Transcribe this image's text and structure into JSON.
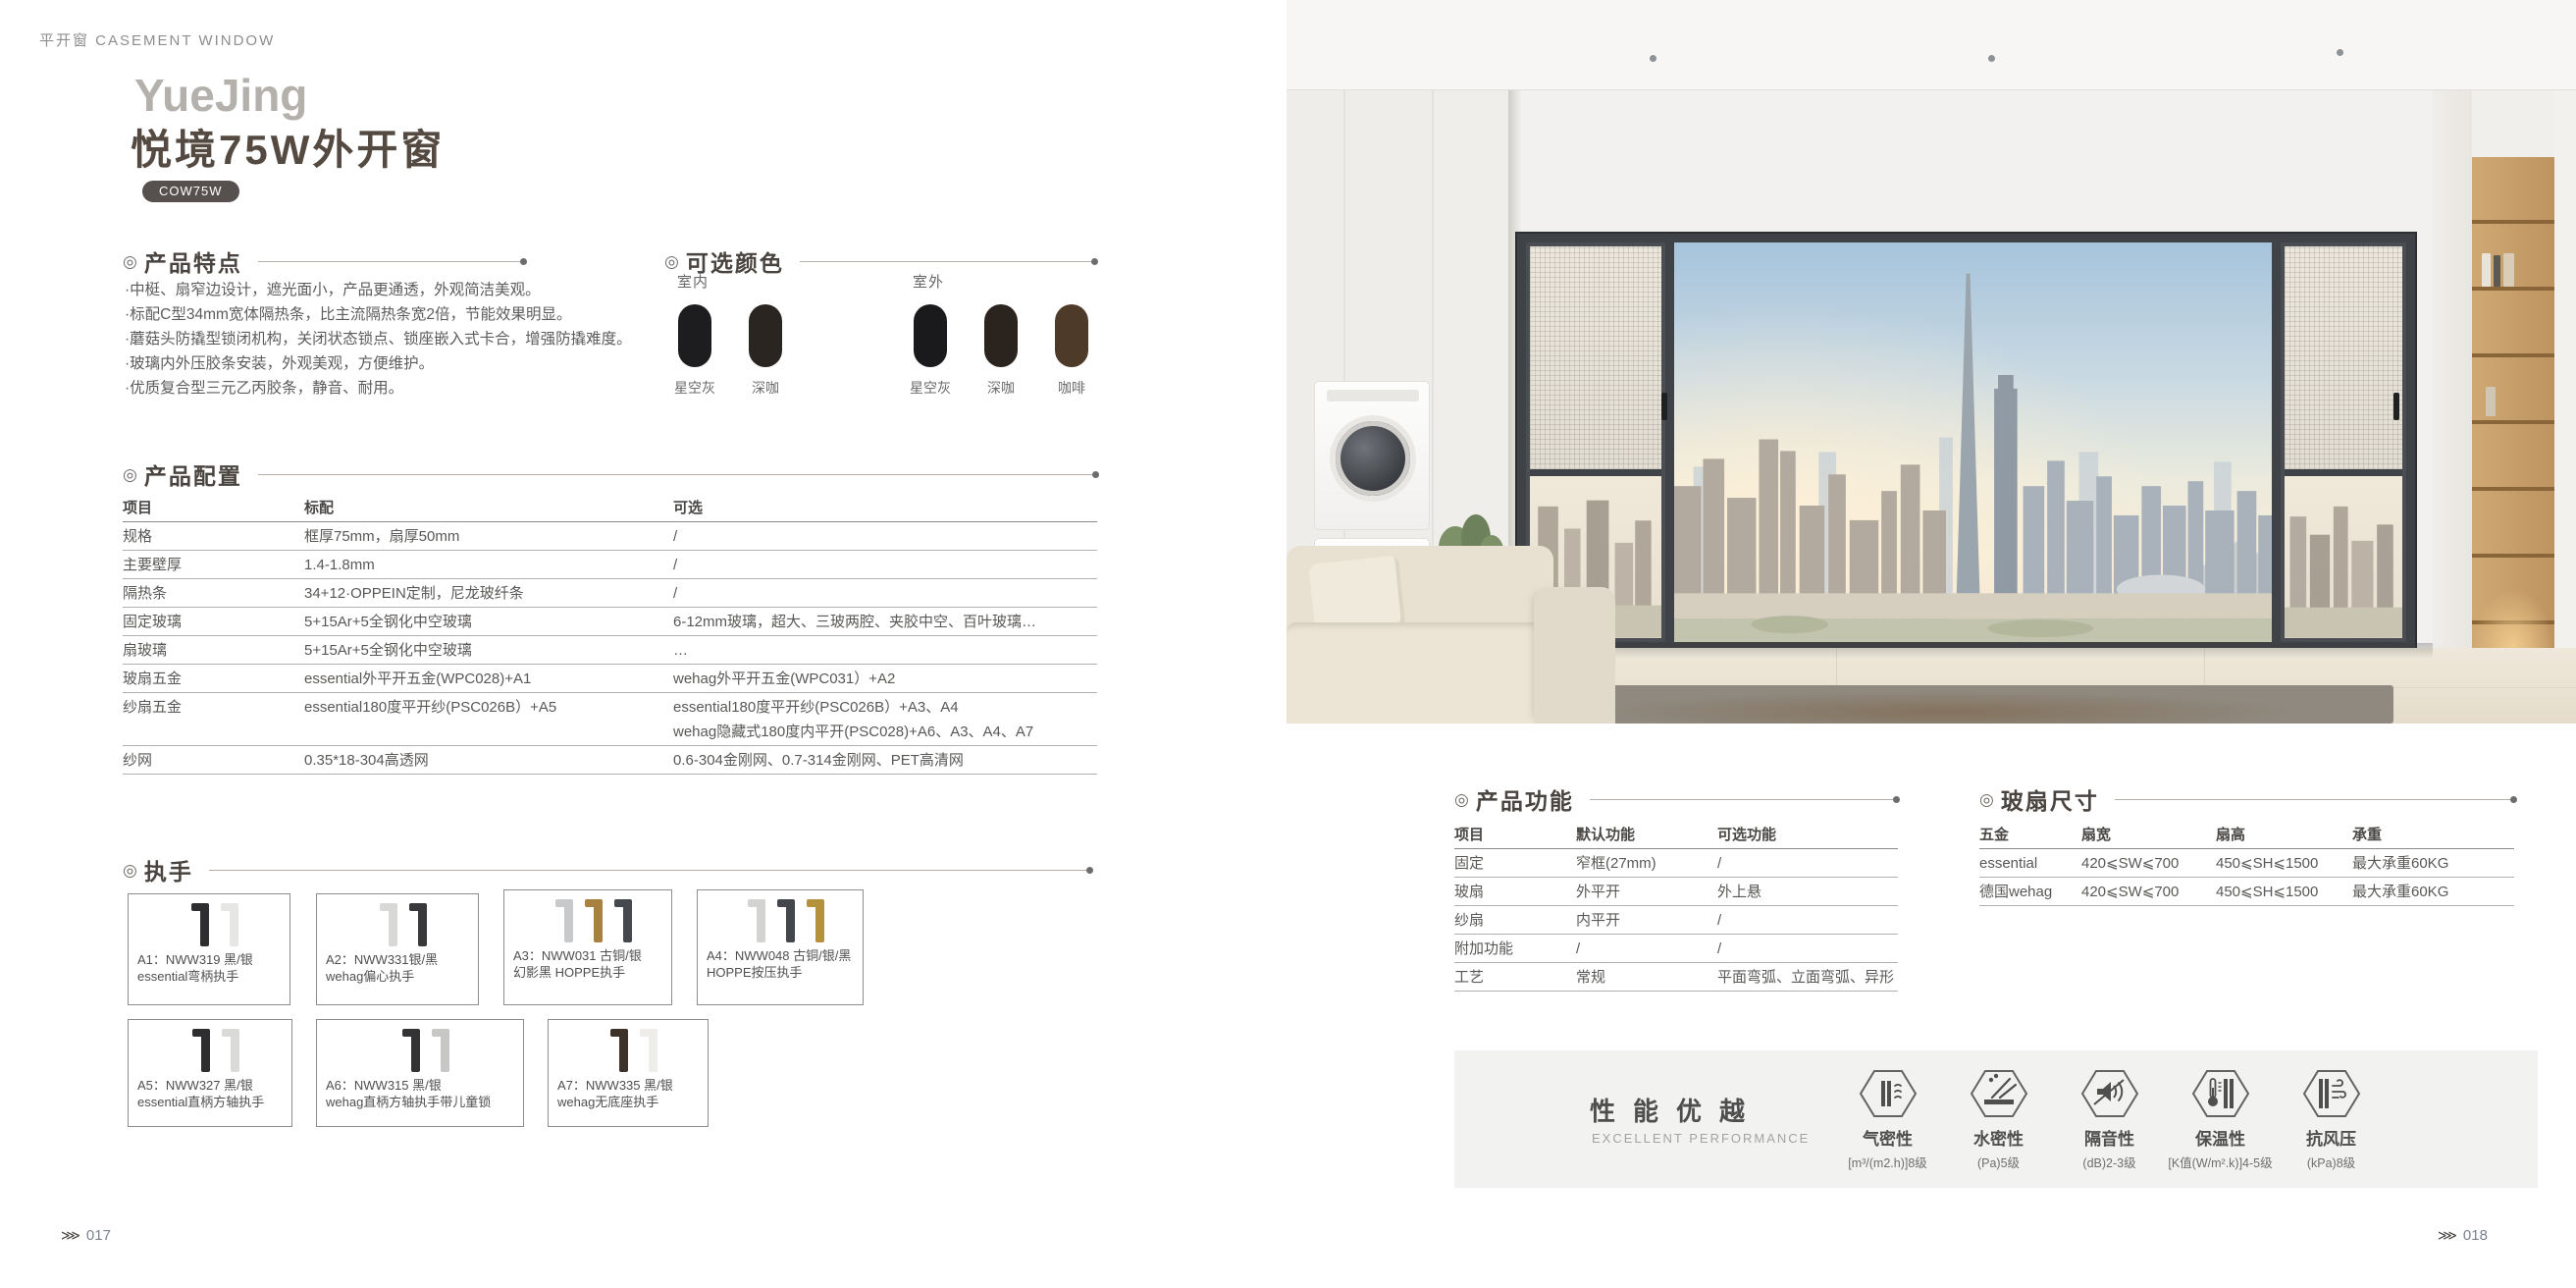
{
  "ui": {
    "marker": "◎",
    "page_marker": "⋙"
  },
  "page_header": {
    "label": "平开窗 CASEMENT WINDOW"
  },
  "title": {
    "en": "YueJing",
    "cn": "悦境75W外开窗",
    "model_badge": "COW75W"
  },
  "features": {
    "heading": "产品特点",
    "items": [
      "·中梃、扇窄边设计，遮光面小，产品更通透，外观简洁美观。",
      "·标配C型34mm宽体隔热条，比主流隔热条宽2倍，节能效果明显。",
      "·蘑菇头防撬型锁闭机构，关闭状态锁点、锁座嵌入式卡合，增强防撬难度。",
      "·玻璃内外压胶条安装，外观美观，方便维护。",
      "·优质复合型三元乙丙胶条，静音、耐用。"
    ]
  },
  "colors": {
    "heading": "可选颜色",
    "indoor": {
      "label": "室内",
      "swatches": [
        {
          "name": "星空灰",
          "hex": "#1d1d1f"
        },
        {
          "name": "深咖",
          "hex": "#2b2522"
        }
      ]
    },
    "outdoor": {
      "label": "室外",
      "swatches": [
        {
          "name": "星空灰",
          "hex": "#1a1a1c"
        },
        {
          "name": "深咖",
          "hex": "#2b241e"
        },
        {
          "name": "咖啡",
          "hex": "#4e3a28"
        }
      ]
    }
  },
  "config": {
    "heading": "产品配置",
    "columns": [
      "项目",
      "标配",
      "可选"
    ],
    "rows": [
      [
        "规格",
        "框厚75mm，扇厚50mm",
        "/"
      ],
      [
        "主要壁厚",
        "1.4-1.8mm",
        "/"
      ],
      [
        "隔热条",
        "34+12·OPPEIN定制，尼龙玻纤条",
        "/"
      ],
      [
        "固定玻璃",
        "5+15Ar+5全钢化中空玻璃",
        "6-12mm玻璃，超大、三玻两腔、夹胶中空、百叶玻璃…"
      ],
      [
        "扇玻璃",
        "5+15Ar+5全钢化中空玻璃",
        "…"
      ],
      [
        "玻扇五金",
        "essential外平开五金(WPC028)+A1",
        "wehag外平开五金(WPC031）+A2"
      ],
      [
        "纱扇五金",
        "essential180度平开纱(PSC026B）+A5",
        [
          "essential180度平开纱(PSC026B）+A3、A4",
          "wehag隐藏式180度内平开(PSC028)+A6、A3、A4、A7"
        ]
      ],
      [
        "纱网",
        "0.35*18-304高透网",
        "0.6-304金刚网、0.7-314金刚网、PET高清网"
      ]
    ]
  },
  "handles": {
    "heading": "执手",
    "items": [
      {
        "code": "A1：NWW319 黑/银",
        "desc": "essential弯柄执手",
        "colors": [
          "#2e2e30",
          "#e6e6e4"
        ]
      },
      {
        "code": "A2：NWW331银/黑",
        "desc": "wehag偏心执手",
        "colors": [
          "#d8d8d6",
          "#39393b"
        ]
      },
      {
        "code": "A3：NWW031 古铜/银",
        "desc": "幻影黑 HOPPE执手",
        "colors": [
          "#c7c9cb",
          "#a8813e",
          "#45494e"
        ]
      },
      {
        "code": "A4：NWW048 古铜/银/黑",
        "desc": "HOPPE按压执手",
        "colors": [
          "#d3d3d1",
          "#43474c",
          "#b5913c"
        ]
      },
      {
        "code": "A5：NWW327 黑/银",
        "desc": "essential直柄方轴执手",
        "colors": [
          "#2e2e30",
          "#dadad8"
        ]
      },
      {
        "code": "A6：NWW315 黑/银",
        "desc": "wehag直柄方轴执手带儿童锁",
        "colors": [
          "#333335",
          "#c7c7c5"
        ]
      },
      {
        "code": "A7：NWW335 黑/银",
        "desc": "wehag无底座执手",
        "colors": [
          "#3d322a",
          "#eeede9"
        ]
      }
    ]
  },
  "functions": {
    "heading": "产品功能",
    "columns": [
      "项目",
      "默认功能",
      "可选功能"
    ],
    "rows": [
      [
        "固定",
        "窄框(27mm)",
        "/"
      ],
      [
        "玻扇",
        "外平开",
        "外上悬"
      ],
      [
        "纱扇",
        "内平开",
        "/"
      ],
      [
        "附加功能",
        "/",
        "/"
      ],
      [
        "工艺",
        "常规",
        "平面弯弧、立面弯弧、异形"
      ]
    ]
  },
  "sash_size": {
    "heading": "玻扇尺寸",
    "columns": [
      "五金",
      "扇宽",
      "扇高",
      "承重"
    ],
    "rows": [
      [
        "essential",
        "420⩽SW⩽700",
        "450⩽SH⩽1500",
        "最大承重60KG"
      ],
      [
        "德国wehag",
        "420⩽SW⩽700",
        "450⩽SH⩽1500",
        "最大承重60KG"
      ]
    ]
  },
  "performance": {
    "title": "性能优越",
    "subtitle": "EXCELLENT PERFORMANCE",
    "metrics": [
      {
        "icon": "air-tightness-icon",
        "name": "气密性",
        "value": "[m³/(m2.h)]8级"
      },
      {
        "icon": "water-tightness-icon",
        "name": "水密性",
        "value": "(Pa)5级"
      },
      {
        "icon": "sound-insulation-icon",
        "name": "隔音性",
        "value": "(dB)2-3级"
      },
      {
        "icon": "thermal-insulation-icon",
        "name": "保温性",
        "value": "[K值(W/m².k)]4-5级"
      },
      {
        "icon": "wind-pressure-icon",
        "name": "抗风压",
        "value": "(kPa)8级"
      }
    ]
  },
  "page_numbers": {
    "left": "017",
    "right": "018"
  }
}
